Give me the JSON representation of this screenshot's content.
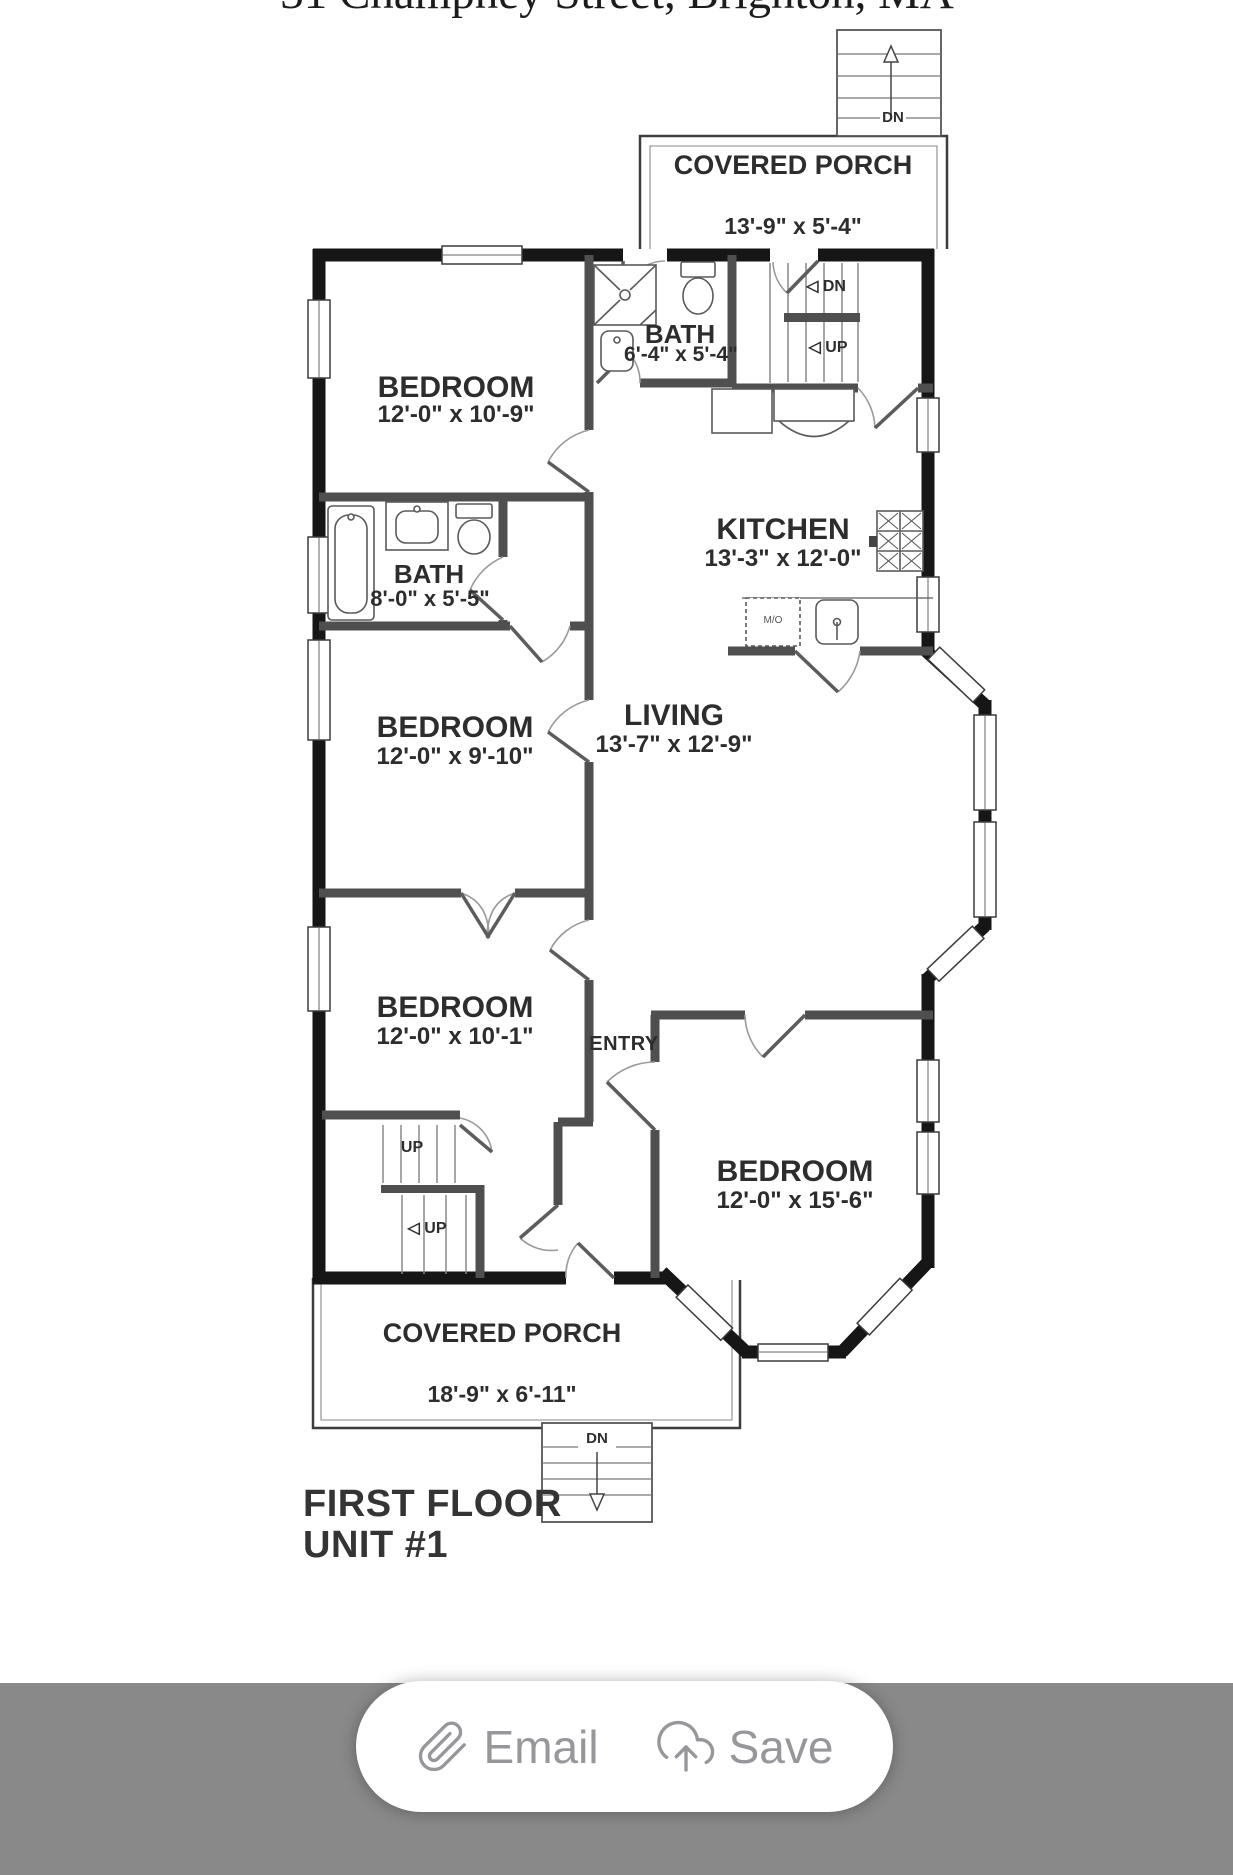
{
  "window": {
    "address_title": "31 Champney Street, Brighton, MA"
  },
  "floor_plan": {
    "rooms": {
      "porch_top": {
        "name": "COVERED PORCH",
        "dims": "13'-9\" x 5'-4\""
      },
      "bedroom1": {
        "name": "BEDROOM",
        "dims": "12'-0\" x 10'-9\""
      },
      "bath_top": {
        "name": "BATH",
        "dims": "6'-4\" x 5'-4\""
      },
      "kitchen": {
        "name": "KITCHEN",
        "dims": "13'-3\" x 12'-0\""
      },
      "bath_left": {
        "name": "BATH",
        "dims": "8'-0\" x 5'-5\""
      },
      "bedroom2": {
        "name": "BEDROOM",
        "dims": "12'-0\" x 9'-10\""
      },
      "living": {
        "name": "LIVING",
        "dims": "13'-7\" x 12'-9\""
      },
      "bedroom3": {
        "name": "BEDROOM",
        "dims": "12'-0\" x 10'-1\""
      },
      "entry": {
        "name": "ENTRY"
      },
      "bedroom4": {
        "name": "BEDROOM",
        "dims": "12'-0\" x 15'-6\""
      },
      "porch_bottom": {
        "name": "COVERED PORCH",
        "dims": "18'-9\" x 6'-11\""
      }
    },
    "stairs": {
      "top_exterior_dn": "DN",
      "interior_dn": "◁ DN",
      "interior_up": "◁ UP",
      "bottom_interior_up1": "UP",
      "bottom_interior_up2": "◁ UP",
      "bottom_exterior_dn": "DN"
    },
    "appliance_label": "M/O",
    "floor_title_line1": "FIRST FLOOR",
    "floor_title_line2": "UNIT #1"
  },
  "toolbar": {
    "email_label": "Email",
    "save_label": "Save",
    "icons": {
      "email": "paperclip-icon",
      "save": "cloud-upload-icon"
    },
    "colors": {
      "bar_background": "#898989",
      "pill_background": "#ffffff",
      "button_foreground": "#97979b"
    }
  },
  "colors": {
    "exterior_wall": "#161616",
    "interior_wall": "#4f4f4f",
    "plan_text": "#2d2d2d",
    "background": "#ffffff"
  }
}
